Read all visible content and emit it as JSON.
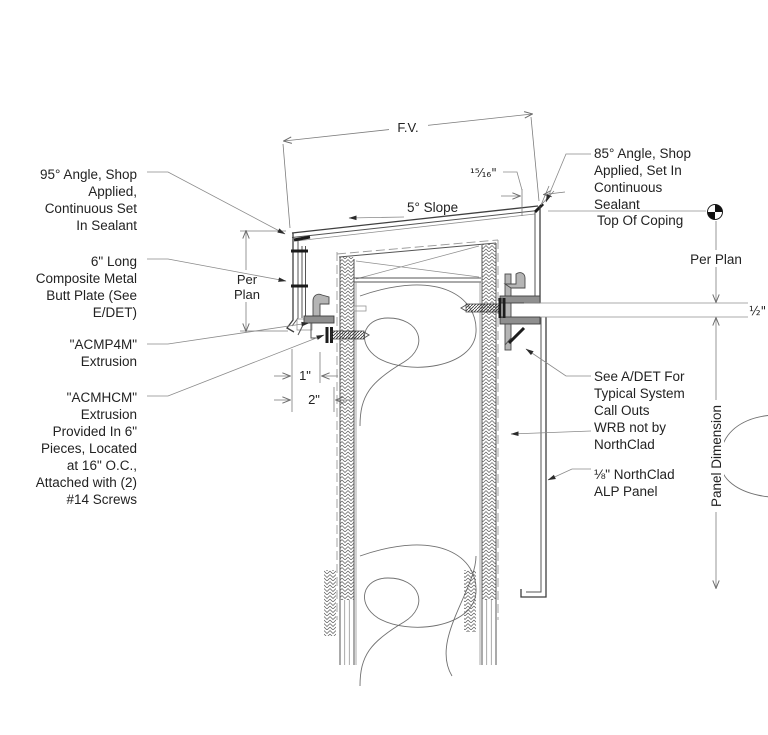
{
  "drawing_title_implied": "Coping / Top Of Wall Detail",
  "colors": {
    "linework": "#3f3f3f",
    "thin_lines": "#8f8f8f",
    "text": "#222222",
    "background": "#ffffff"
  },
  "annotations": {
    "angle95": {
      "lines": [
        "95° Angle, Shop",
        "Applied,",
        "Continuous Set",
        "In Sealant"
      ]
    },
    "butt_plate": {
      "lines": [
        "6\" Long",
        "Composite Metal",
        "Butt Plate (See",
        "E/DET)"
      ]
    },
    "acmp4m": {
      "lines": [
        "\"ACMP4M\"",
        "Extrusion"
      ]
    },
    "acmhcm": {
      "lines": [
        "\"ACMHCM\"",
        "Extrusion",
        "Provided In 6\"",
        "Pieces, Located",
        "at 16\" O.C.,",
        "Attached with (2)",
        "#14 Screws"
      ]
    },
    "angle85": {
      "lines": [
        "85° Angle, Shop",
        "Applied,  Set In",
        "Continuous",
        "Sealant"
      ]
    },
    "top_of_coping": "Top Of Coping",
    "per_plan_right": "Per Plan",
    "per_plan_left": {
      "lines": [
        "Per",
        "Plan"
      ]
    },
    "see_adet": {
      "lines": [
        "See A/DET For",
        "Typical System",
        "Call Outs"
      ]
    },
    "wrb": {
      "lines": [
        "WRB not by",
        "NorthClad"
      ]
    },
    "alp_panel": {
      "lines": [
        "⅛\" NorthClad",
        "ALP Panel"
      ]
    },
    "panel_dimension": "Panel Dimension"
  },
  "dimensions": {
    "face_view": "F.V.",
    "slope": "5° Slope",
    "coping_offset": "¹⁵⁄₁₆\"",
    "joint_gap": "½\"",
    "clip_projection": "1\"",
    "assembly_projection": "2\""
  }
}
